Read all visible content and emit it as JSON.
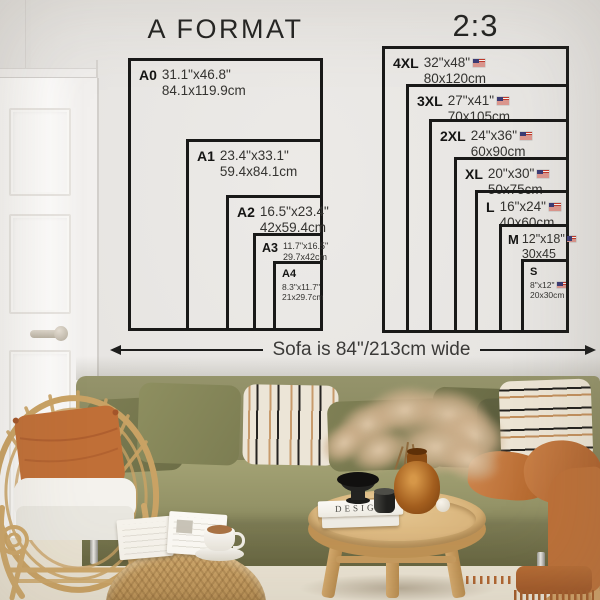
{
  "size_guide": {
    "a_format": {
      "title": "A FORMAT",
      "sizes": [
        {
          "label": "A0",
          "inches": "31.1\"x46.8\"",
          "cm": "84.1x119.9cm"
        },
        {
          "label": "A1",
          "inches": "23.4\"x33.1\"",
          "cm": "59.4x84.1cm"
        },
        {
          "label": "A2",
          "inches": "16.5\"x23.4\"",
          "cm": "42x59.4cm"
        },
        {
          "label": "A3",
          "inches": "11.7\"x16.5\"",
          "cm": "29.7x42cm"
        },
        {
          "label": "A4",
          "inches": "8.3\"x11.7\"",
          "cm": "21x29.7cm"
        }
      ]
    },
    "ratio": {
      "title": "2:3",
      "flag_icon": "us-flag",
      "sizes": [
        {
          "label": "4XL",
          "inches": "32\"x48\"",
          "cm": "80x120cm"
        },
        {
          "label": "3XL",
          "inches": "27\"x41\"",
          "cm": "70x105cm"
        },
        {
          "label": "2XL",
          "inches": "24\"x36\"",
          "cm": "60x90cm"
        },
        {
          "label": "XL",
          "inches": "20\"x30\"",
          "cm": "50x75cm"
        },
        {
          "label": "L",
          "inches": "16\"x24\"",
          "cm": "40x60cm"
        },
        {
          "label": "M",
          "inches": "12\"x18\"",
          "cm": "30x45"
        },
        {
          "label": "S",
          "inches": "8\"x12\"",
          "cm": "20x30cm"
        }
      ]
    },
    "sofa_note": "Sofa is 84\"/213cm wide"
  },
  "scene": {
    "book_title": "DESIGN",
    "colors": {
      "wall": "#e8e6e3",
      "chart_line": "#191918",
      "sofa_olive": "#8f8e63",
      "pillow_rust": "#bf6d36",
      "throw_rust": "#b96f39",
      "stripe_black": "#262422",
      "stripe_tan": "#bc8758",
      "rattan": "#c9a264",
      "wood": "#d3ae74",
      "rug": "#e9e2d2",
      "amber_glass": "#a35e1e"
    }
  }
}
